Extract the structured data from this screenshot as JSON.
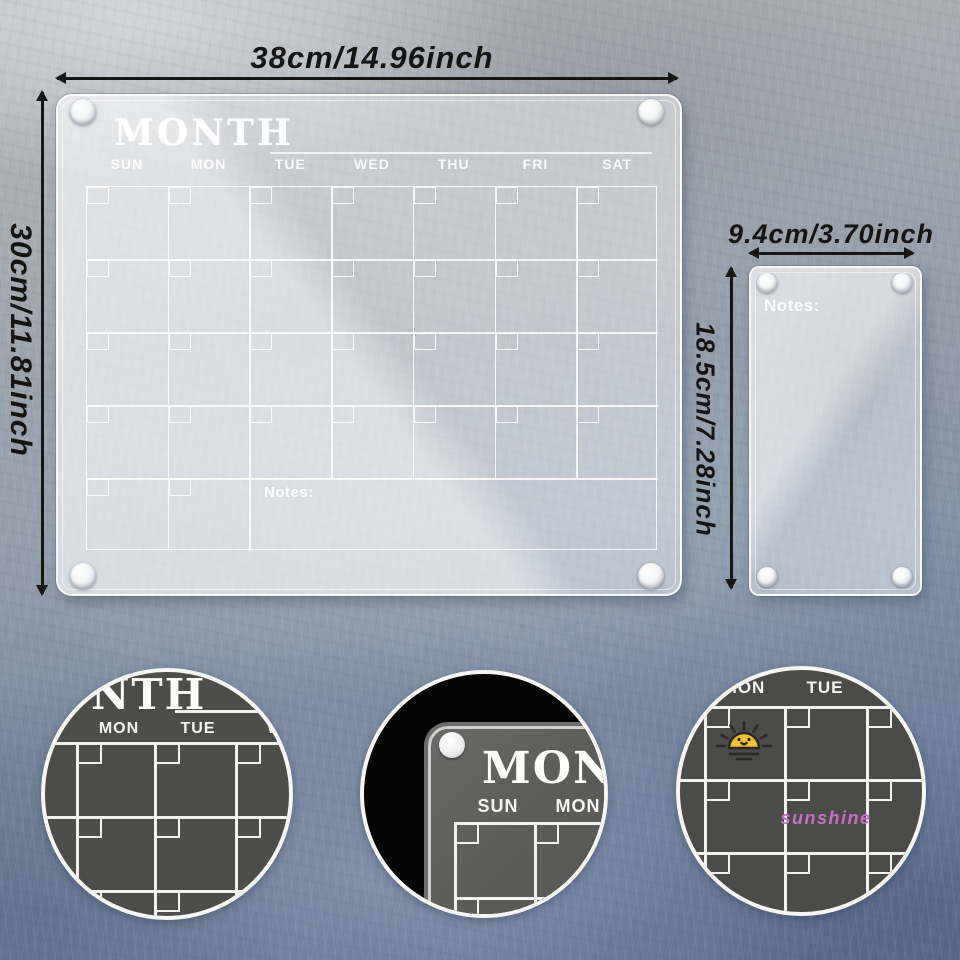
{
  "dimensions": {
    "board_width": "38cm/14.96inch",
    "board_height": "30cm/11.81inch",
    "notes_board_width": "9.4cm/3.70inch",
    "notes_board_height": "18.5cm/7.28inch"
  },
  "main_board": {
    "title": "MONTH",
    "days": [
      "SUN",
      "MON",
      "TUE",
      "WED",
      "THU",
      "FRI",
      "SAT"
    ],
    "notes_label": "Notes:"
  },
  "notes_board": {
    "label": "Notes:"
  },
  "detail_circles": {
    "left": {
      "title_fragment": "NTH",
      "days": [
        "MON",
        "TUE",
        "WE"
      ]
    },
    "middle": {
      "title": "MONTH",
      "days": [
        "SUN",
        "MON"
      ]
    },
    "right": {
      "days": [
        "MON",
        "TUE"
      ],
      "handwriting": "sunshine",
      "icon": "sun-doodle-icon"
    }
  },
  "colors": {
    "dimension_text": "#141414",
    "board_lines": "#ffffff",
    "detail_background": "#4c4c4a",
    "handwriting_pink": "#c76ec7",
    "sun_yellow": "#f2c230"
  }
}
